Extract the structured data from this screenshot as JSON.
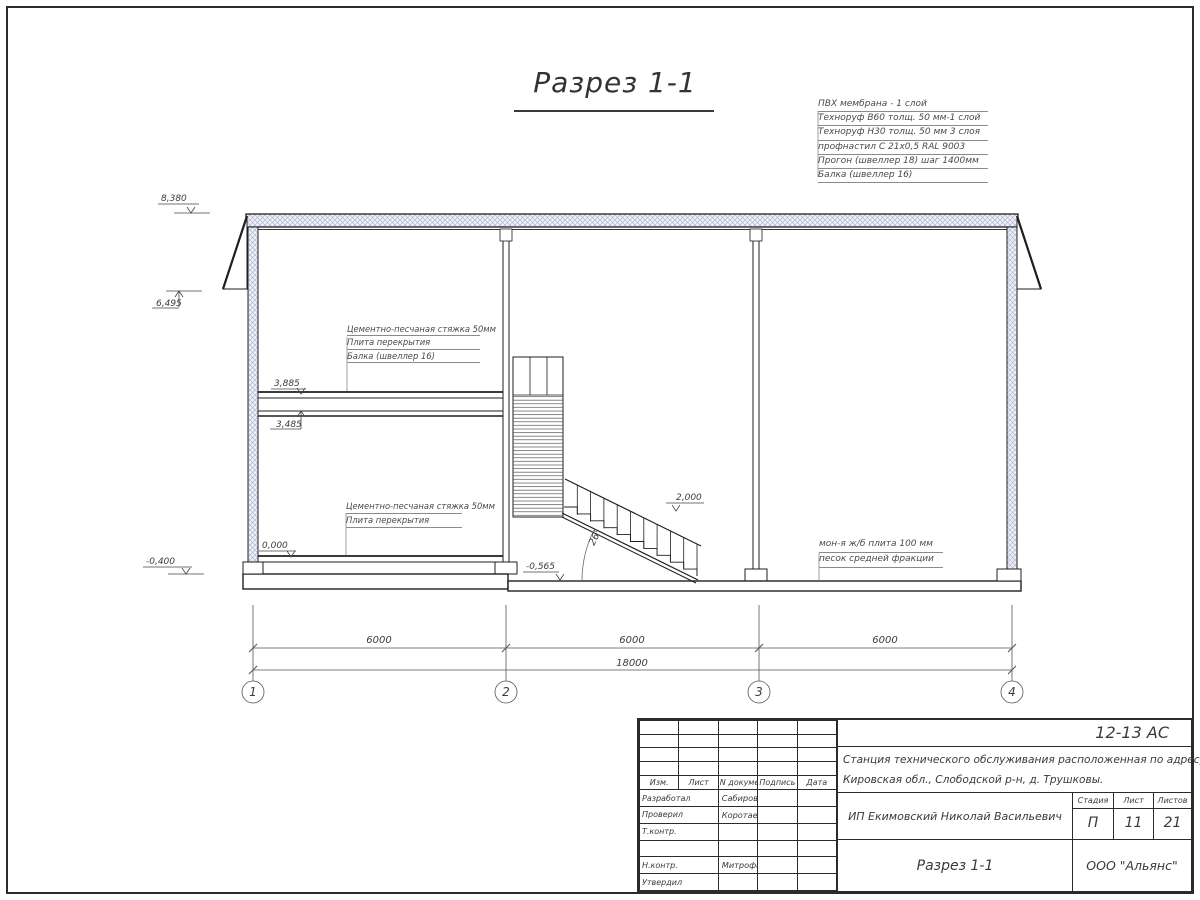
{
  "drawing": {
    "title": "Разрез 1-1"
  },
  "roof_legend": [
    "ПВХ мембрана - 1 слой",
    "Техноруф В60 толщ. 50 мм-1 слой",
    "Техноруф Н30 толщ. 50 мм 3 слоя",
    "профнастил С 21х0,5 RAL 9003",
    "Прогон (швеллер 18) шаг 1400мм",
    "Балка (швеллер 16)"
  ],
  "floor2_legend": [
    "Цементно-песчаная стяжка 50мм",
    "Плита перекрытия",
    "Балка (швеллер 16)"
  ],
  "floor1_legend": [
    "Цементно-песчаная стяжка 50мм",
    "Плита перекрытия"
  ],
  "slab_legend": [
    "мон-я ж/б плита 100 мм",
    "песок средней фракции"
  ],
  "elevations": {
    "roof": "8,380",
    "eave": "6,495",
    "floor2_top": "3,885",
    "floor2_bottom": "3,485",
    "ground": "0,000",
    "foundation": "-0,400",
    "stair": "2,000",
    "pit": "-0,565"
  },
  "stair_angle": "26°",
  "dims": {
    "span1": "6000",
    "span2": "6000",
    "span3": "6000",
    "total": "18000"
  },
  "axes": [
    "1",
    "2",
    "3",
    "4"
  ],
  "title_block": {
    "code": "12-13 АС",
    "project_line1": "Станция технического обслуживания расположенная по адресу",
    "project_line2": "Кировская обл., Слободской р-н, д. Трушковы.",
    "client": "ИП Екимовский Николай Васильевич",
    "drawing_name": "Разрез 1-1",
    "company": "ООО \"Альянс\"",
    "stage_label": "Стадия",
    "sheet_label": "Лист",
    "sheets_label": "Листов",
    "stage": "П",
    "sheet": "11",
    "sheets": "21",
    "cols": {
      "izm": "Изм.",
      "list": "Лист",
      "doc": "N документа",
      "sign": "Подпись",
      "date": "Дата"
    },
    "rows": [
      {
        "role": "Разработал",
        "name": "Сабиров Р.Н"
      },
      {
        "role": "Проверил",
        "name": "Коротаев С. Н."
      },
      {
        "role": "Т.контр.",
        "name": ""
      },
      {
        "role": "",
        "name": ""
      },
      {
        "role": "Н.контр.",
        "name": "Митрофанов Я. А."
      },
      {
        "role": "Утвердил",
        "name": ""
      }
    ]
  }
}
